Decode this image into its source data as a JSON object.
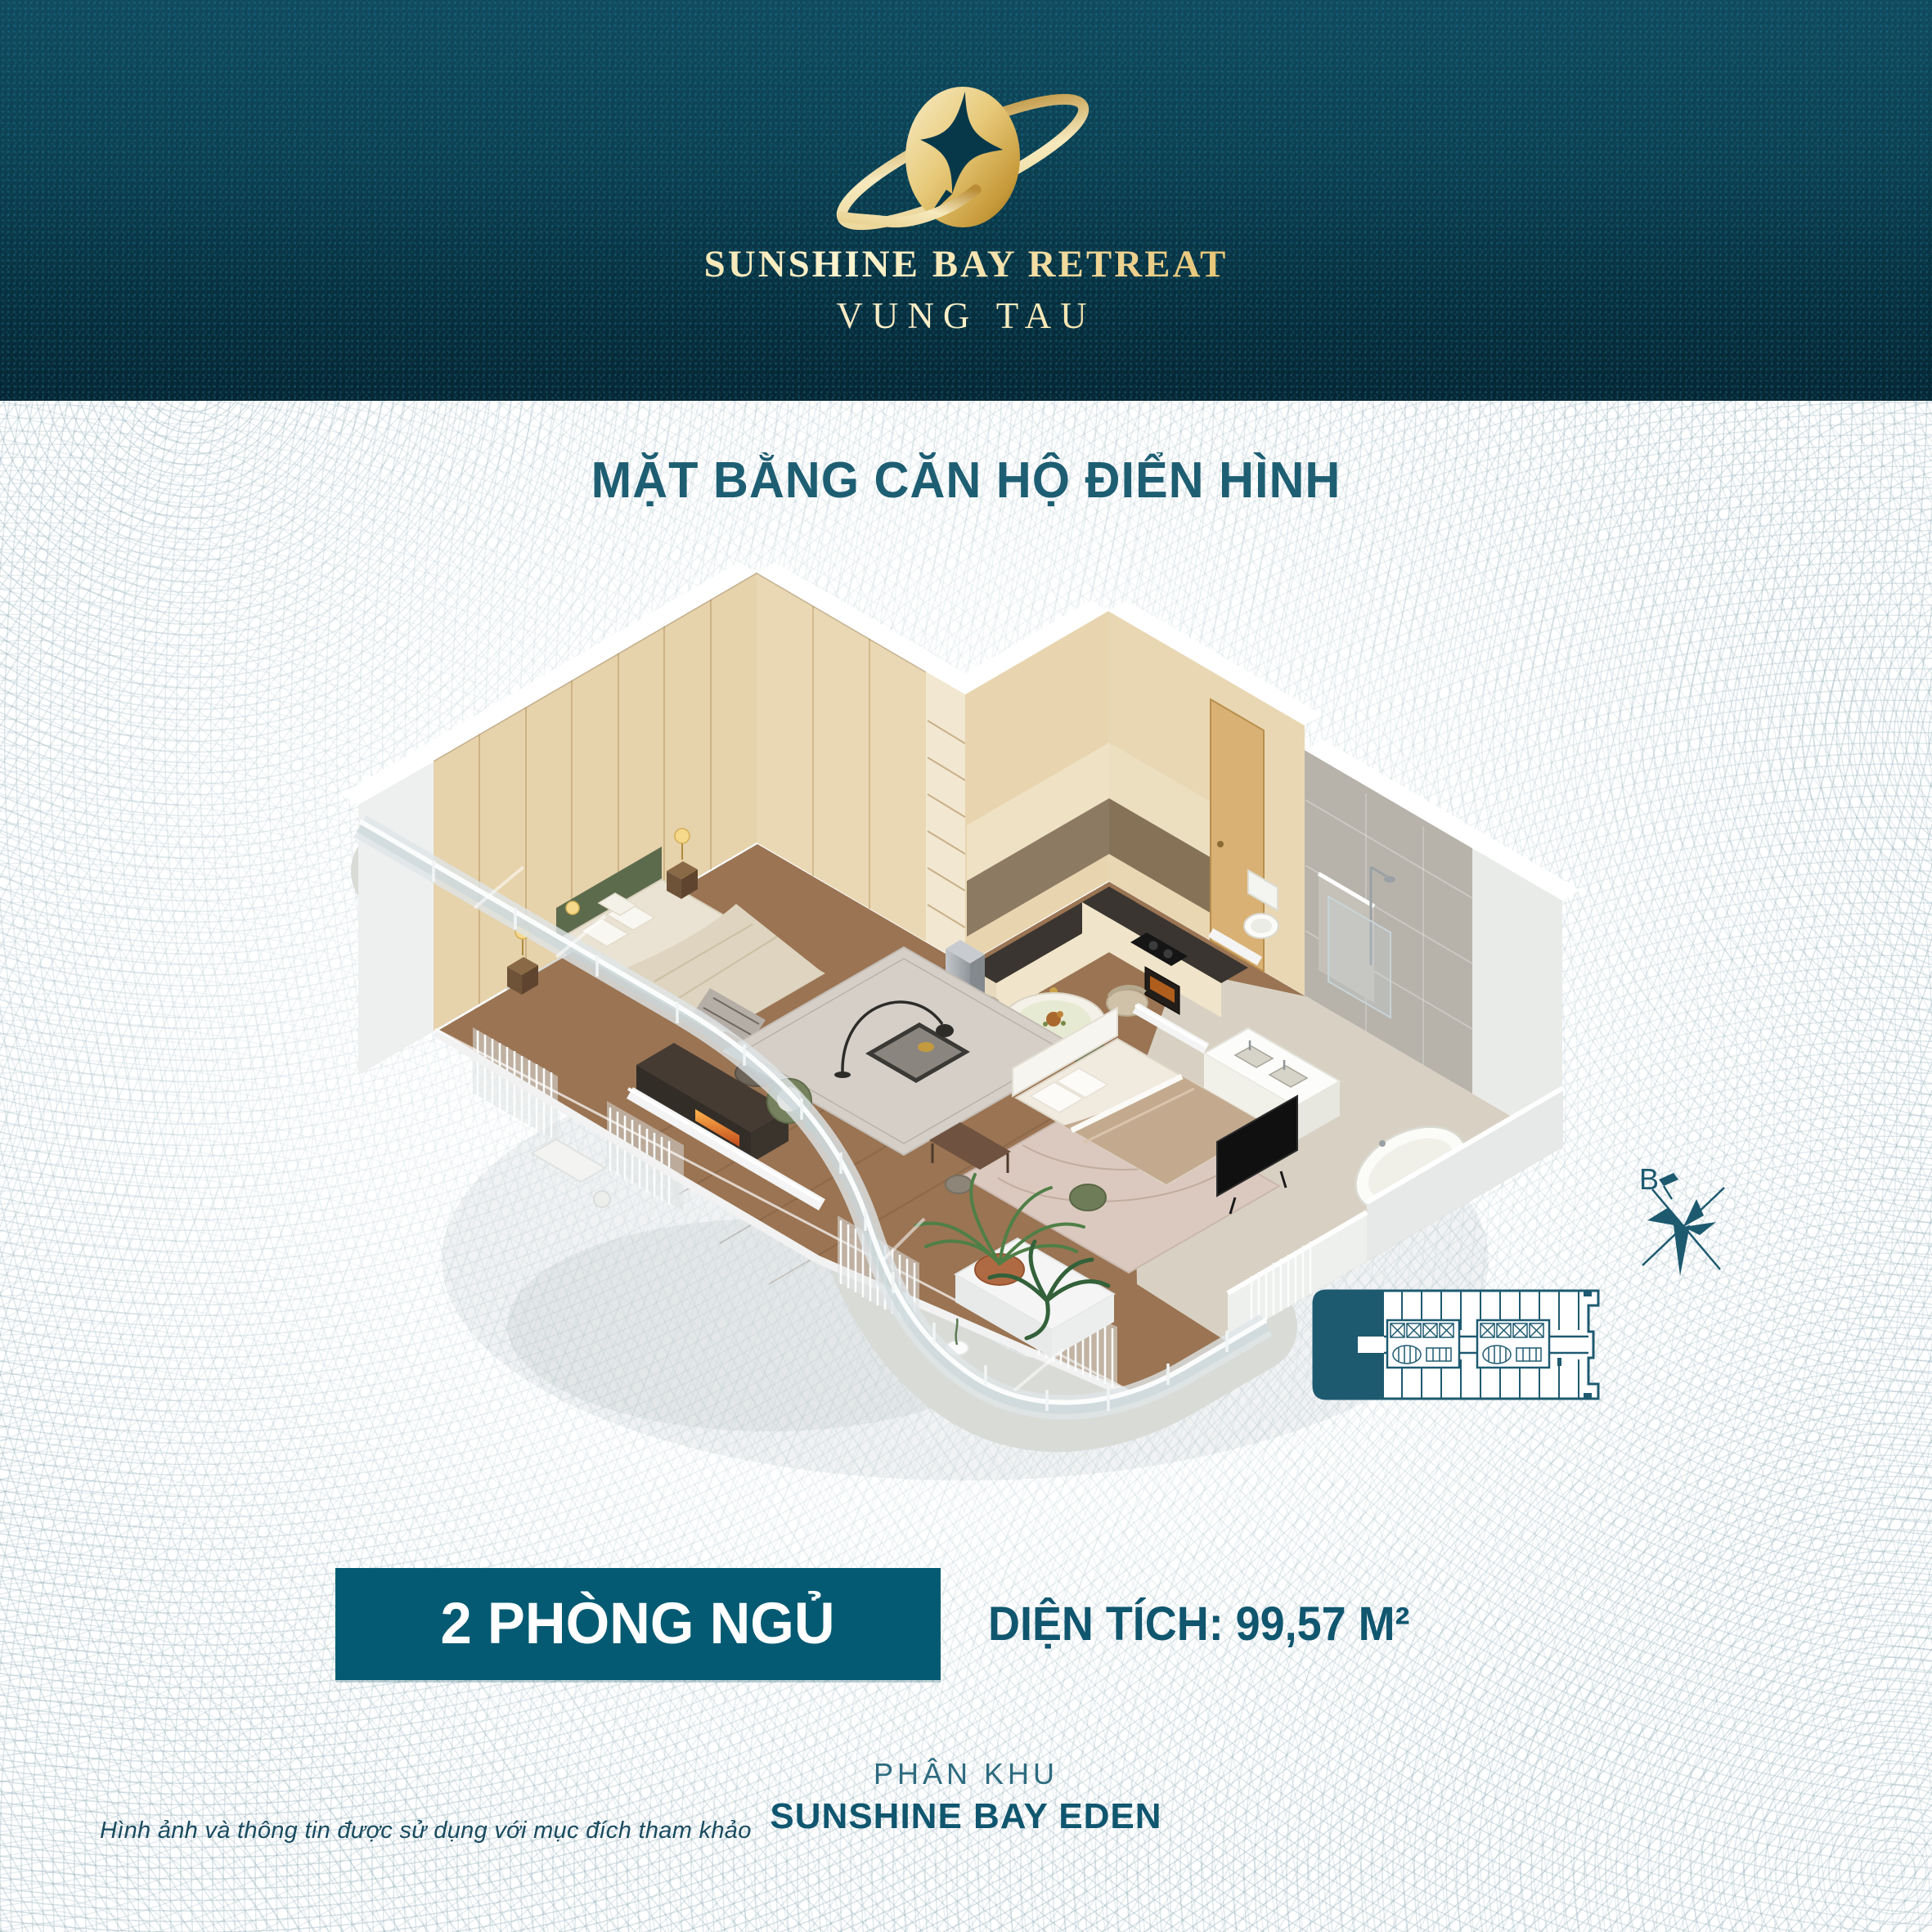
{
  "brand": {
    "name_line1": "SUNSHINE BAY RETREAT",
    "name_line2": "VUNG TAU"
  },
  "heading": {
    "title": "MẶT BẰNG CĂN HỘ ĐIỂN HÌNH"
  },
  "unit_info": {
    "bedrooms": "2 PHÒNG NGỦ",
    "area": "DIỆN TÍCH: 99,57 M²"
  },
  "zone_info": {
    "prefix": "PHÂN KHU",
    "name": "SUNSHINE BAY EDEN"
  },
  "footnote": "Hình ảnh và thông tin được sử dụng với mục đích tham khảo",
  "compass": {
    "north_label": "B"
  },
  "colors": {
    "header_teal": "#0b4052",
    "brand_gold": "#d9b55e",
    "accent_teal": "#1e5e73",
    "badge_teal": "#045a72"
  }
}
